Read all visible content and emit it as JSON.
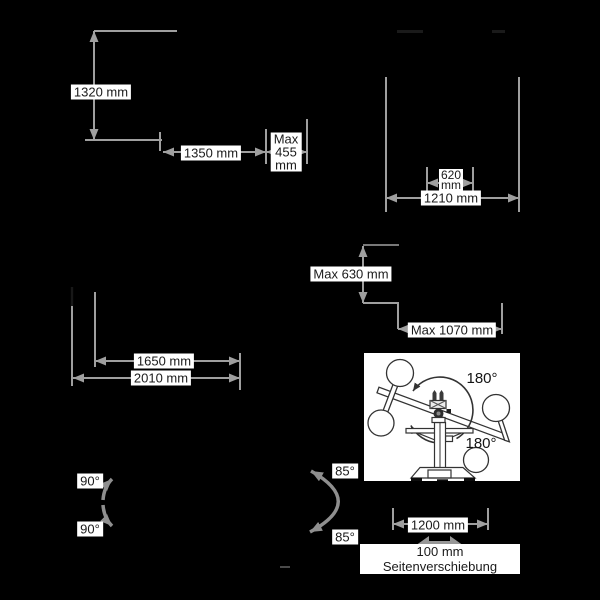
{
  "scene": {
    "background": "#000000",
    "line_color": "#9f9f9f",
    "arrow_color": "#8f8f8f",
    "label_bg": "#ffffff",
    "label_text_color": "#1a1a1a",
    "illustration_line_color": "#333333"
  },
  "labels": {
    "d1320": "1320 mm",
    "d1350": "1350 mm",
    "max455": "Max\n455\nmm",
    "d620": "620\nmm",
    "d1210": "1210 mm",
    "max630": "Max 630 mm",
    "max1070": "Max 1070 mm",
    "d1650": "1650 mm",
    "d2010": "2010 mm",
    "a90_up": "90°",
    "a90_down": "90°",
    "a85_up": "85°",
    "a85_down": "85°",
    "d1200": "1200 mm",
    "side_shift": "100 mm Seitenverschiebung",
    "rot180_top": "180°",
    "rot180_bottom": "180°"
  }
}
